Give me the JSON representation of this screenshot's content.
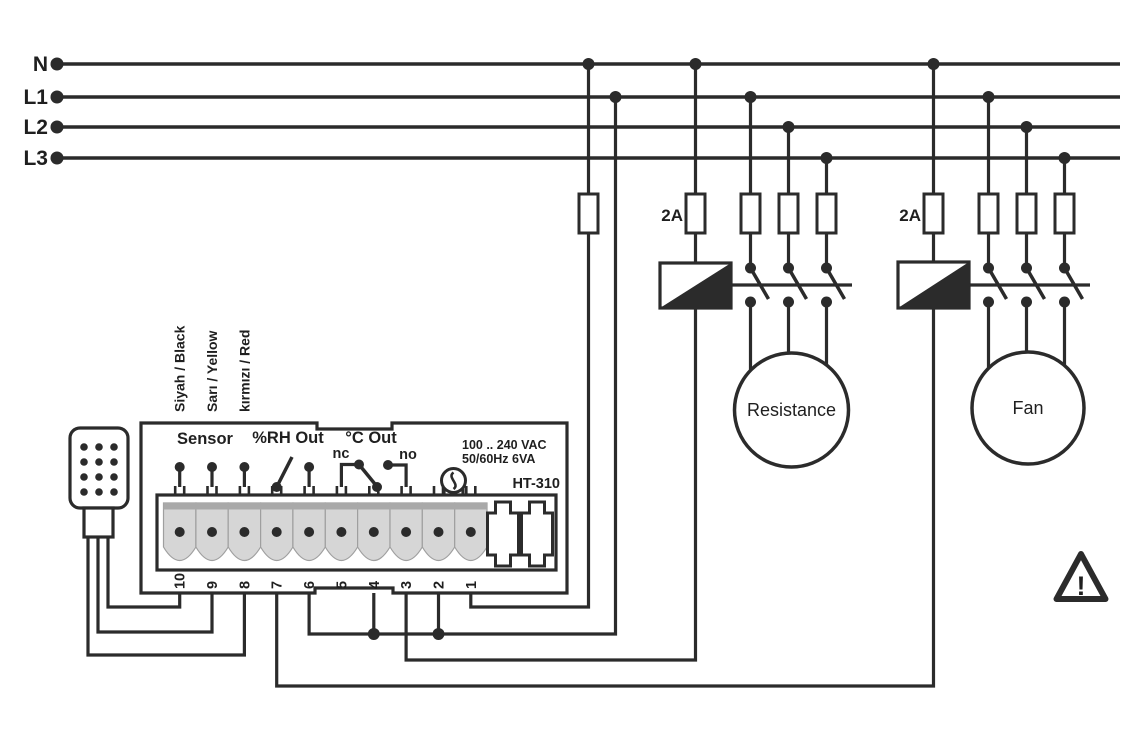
{
  "power_bus": {
    "labels": [
      "N",
      "L1",
      "L2",
      "L3"
    ]
  },
  "fuses": {
    "resistance_group_label": "2A",
    "fan_group_label": "2A"
  },
  "loads": {
    "resistance_label": "Resistance",
    "fan_label": "Fan"
  },
  "controller": {
    "model": "HT-310",
    "sensor_label": "Sensor",
    "rh_output_label": "%RH Out",
    "temp_output_label": "°C Out",
    "nc_label": "nc",
    "no_label": "no",
    "supply_rating_line1": "100 .. 240 VAC",
    "supply_rating_line2": "50/60Hz 6VA",
    "terminal_numbers": [
      "10",
      "9",
      "8",
      "7",
      "6",
      "5",
      "4",
      "3",
      "2",
      "1"
    ]
  },
  "sensor_cable": {
    "wire1": "Siyah / Black",
    "wire2": "Sarı / Yellow",
    "wire3": "kırmızı / Red"
  },
  "warning_symbol": "!",
  "colors": {
    "ink": "#2b2b2b",
    "terminal_fill": "#d6d6d6",
    "terminal_strip": "#a9a9a9",
    "background": "#ffffff"
  }
}
